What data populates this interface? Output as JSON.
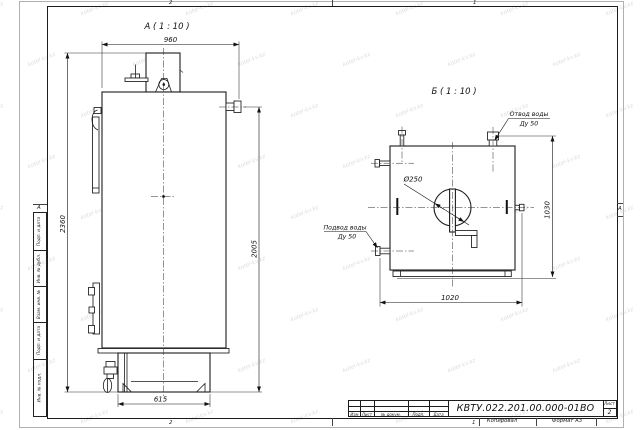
{
  "watermark": {
    "text": "kotel-kv.kz"
  },
  "sheet": {
    "zones": {
      "top_left": "2",
      "top_right": "1",
      "bottom_left": "2",
      "bottom_right": "1",
      "row_left": "А",
      "row_right": "А"
    },
    "margin_columns": [
      "Подп. и дата",
      "Инв. № дубл.",
      "Взам. инв. №",
      "Подп. и дата",
      "Инв. № подл."
    ],
    "footer": {
      "copy": "Копировал",
      "format": "Формат А3"
    }
  },
  "title_block": {
    "doc_number": "КВТУ.022.201.00.000-01ВО",
    "sheet_label": "Лист",
    "sheet_number": "2",
    "change_row": [
      "Изм",
      "Лист",
      "№ докум.",
      "Подп.",
      "Дата"
    ]
  },
  "view_a": {
    "title": "А ( 1 : 10 )",
    "dim_width": "960",
    "dim_height_overall": "2360",
    "dim_height_right": "2005",
    "dim_base_width": "615"
  },
  "view_b": {
    "title": "Б ( 1 : 10 )",
    "dim_height": "1030",
    "dim_width": "1020",
    "dim_hole": "Ø250",
    "callout_outlet": [
      "Отвод воды",
      "Ду 50"
    ],
    "callout_inlet": [
      "Подвод воды",
      "Ду 50"
    ]
  }
}
